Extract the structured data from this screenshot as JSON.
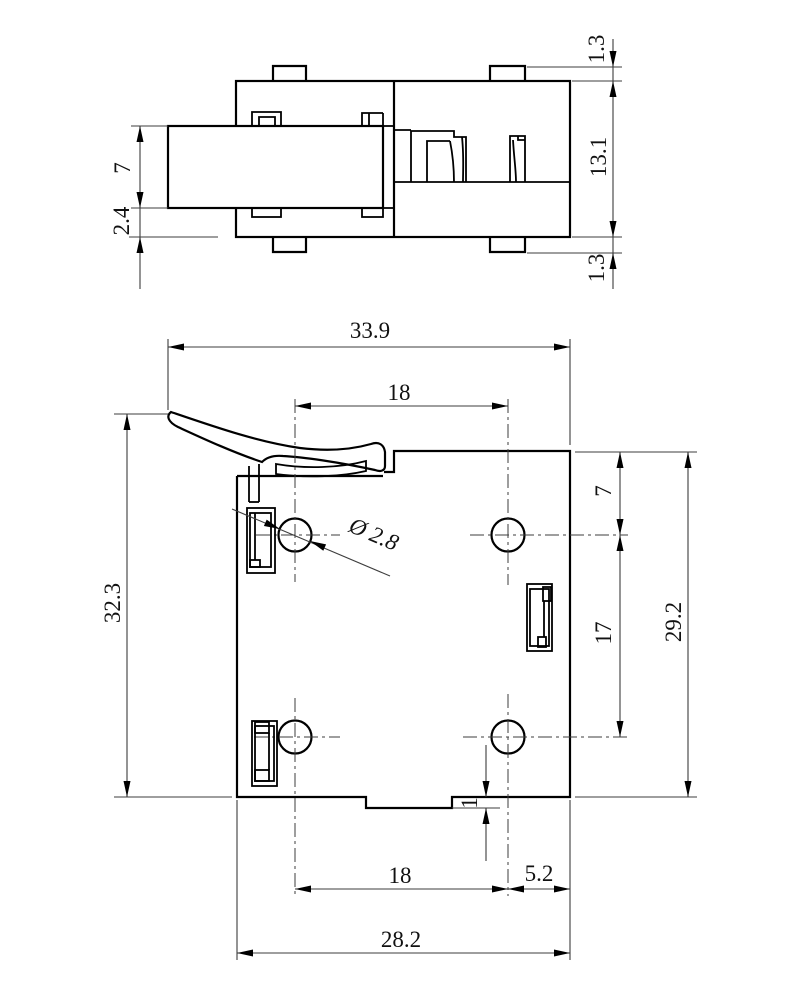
{
  "drawing": {
    "type": "mechanical-part-2-view-dimensioned-drawing",
    "side_view": {
      "label": "side view",
      "dims": {
        "boss_top": "1.3",
        "body_height": "13.1",
        "boss_bottom": "1.3",
        "bolt_height": "7",
        "bolt_to_bottom": "2.4"
      }
    },
    "plan_view": {
      "label": "plan view",
      "dims": {
        "overall_width": "33.9",
        "hole_pitch_top": "18",
        "overall_height": "32.3",
        "body_height": "29.2",
        "top_edge_to_hole": "7",
        "hole_pitch_vertical": "17",
        "hole_diameter": "Ø 2.8",
        "tab_depth": "1",
        "hole_pitch_bottom": "18",
        "hole_to_right_edge": "5.2",
        "body_width": "28.2"
      }
    }
  }
}
